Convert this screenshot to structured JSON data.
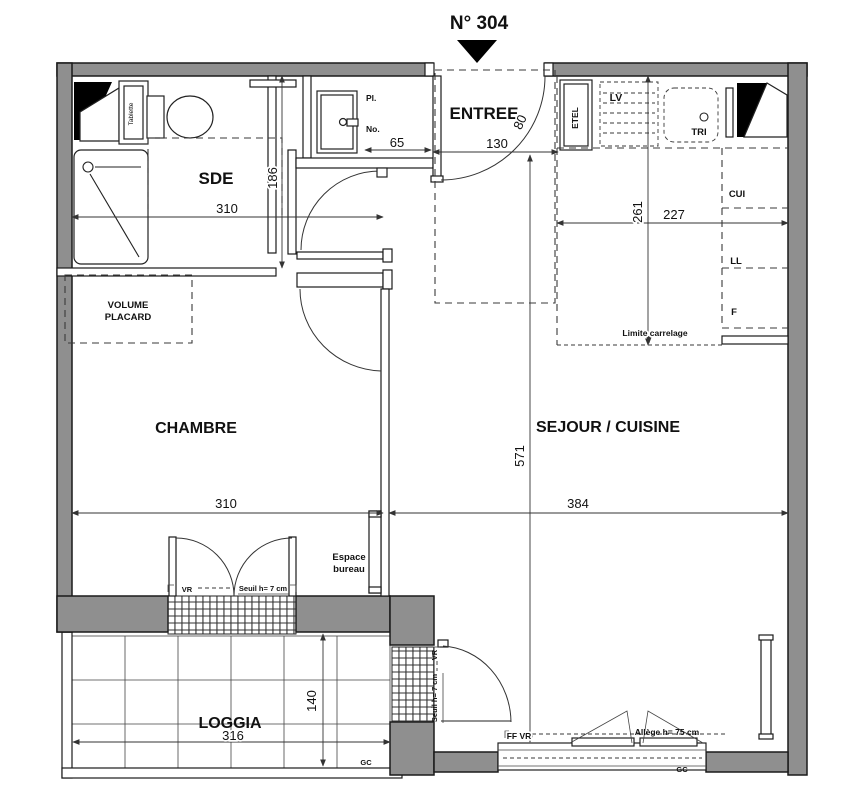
{
  "title": {
    "unit_number": "N° 304"
  },
  "rooms": {
    "sde": "SDE",
    "entree": "ENTREE",
    "chambre": "CHAMBRE",
    "sejour_cuisine": "SEJOUR / CUISINE",
    "loggia": "LOGGIA"
  },
  "fixtures": {
    "tablette": "Tablette",
    "placard_pl": "Pl.",
    "placard_no": "No.",
    "etel": "ETEL",
    "lave_vaisselle": "LV",
    "tri": "TRI",
    "cuisiniere": "CUI",
    "lave_linge": "LL",
    "frigo": "F",
    "volume_placard_line1": "VOLUME",
    "volume_placard_line2": "PLACARD",
    "espace_bureau_line1": "Espace",
    "espace_bureau_line2": "bureau",
    "gc": "GC"
  },
  "annotations": {
    "limite_carrelage": "Limite carrelage",
    "volet_roulant": "VR",
    "seuil": "Seuil h= 7 cm",
    "ff_vr": "FF  VR",
    "allege": "Allège h= 75 cm"
  },
  "dimensions": {
    "sde_width": "310",
    "sde_height": "186",
    "placard_width": "65",
    "entree_width": "130",
    "entree_door_width": "80",
    "cuisine_height": "261",
    "cuisine_width": "227",
    "sejour_height": "571",
    "sejour_width": "384",
    "chambre_width": "310",
    "loggia_depth": "140",
    "loggia_width": "316"
  },
  "colors": {
    "wall_fill": "#8f8f8f",
    "line": "#1a1a1a"
  }
}
